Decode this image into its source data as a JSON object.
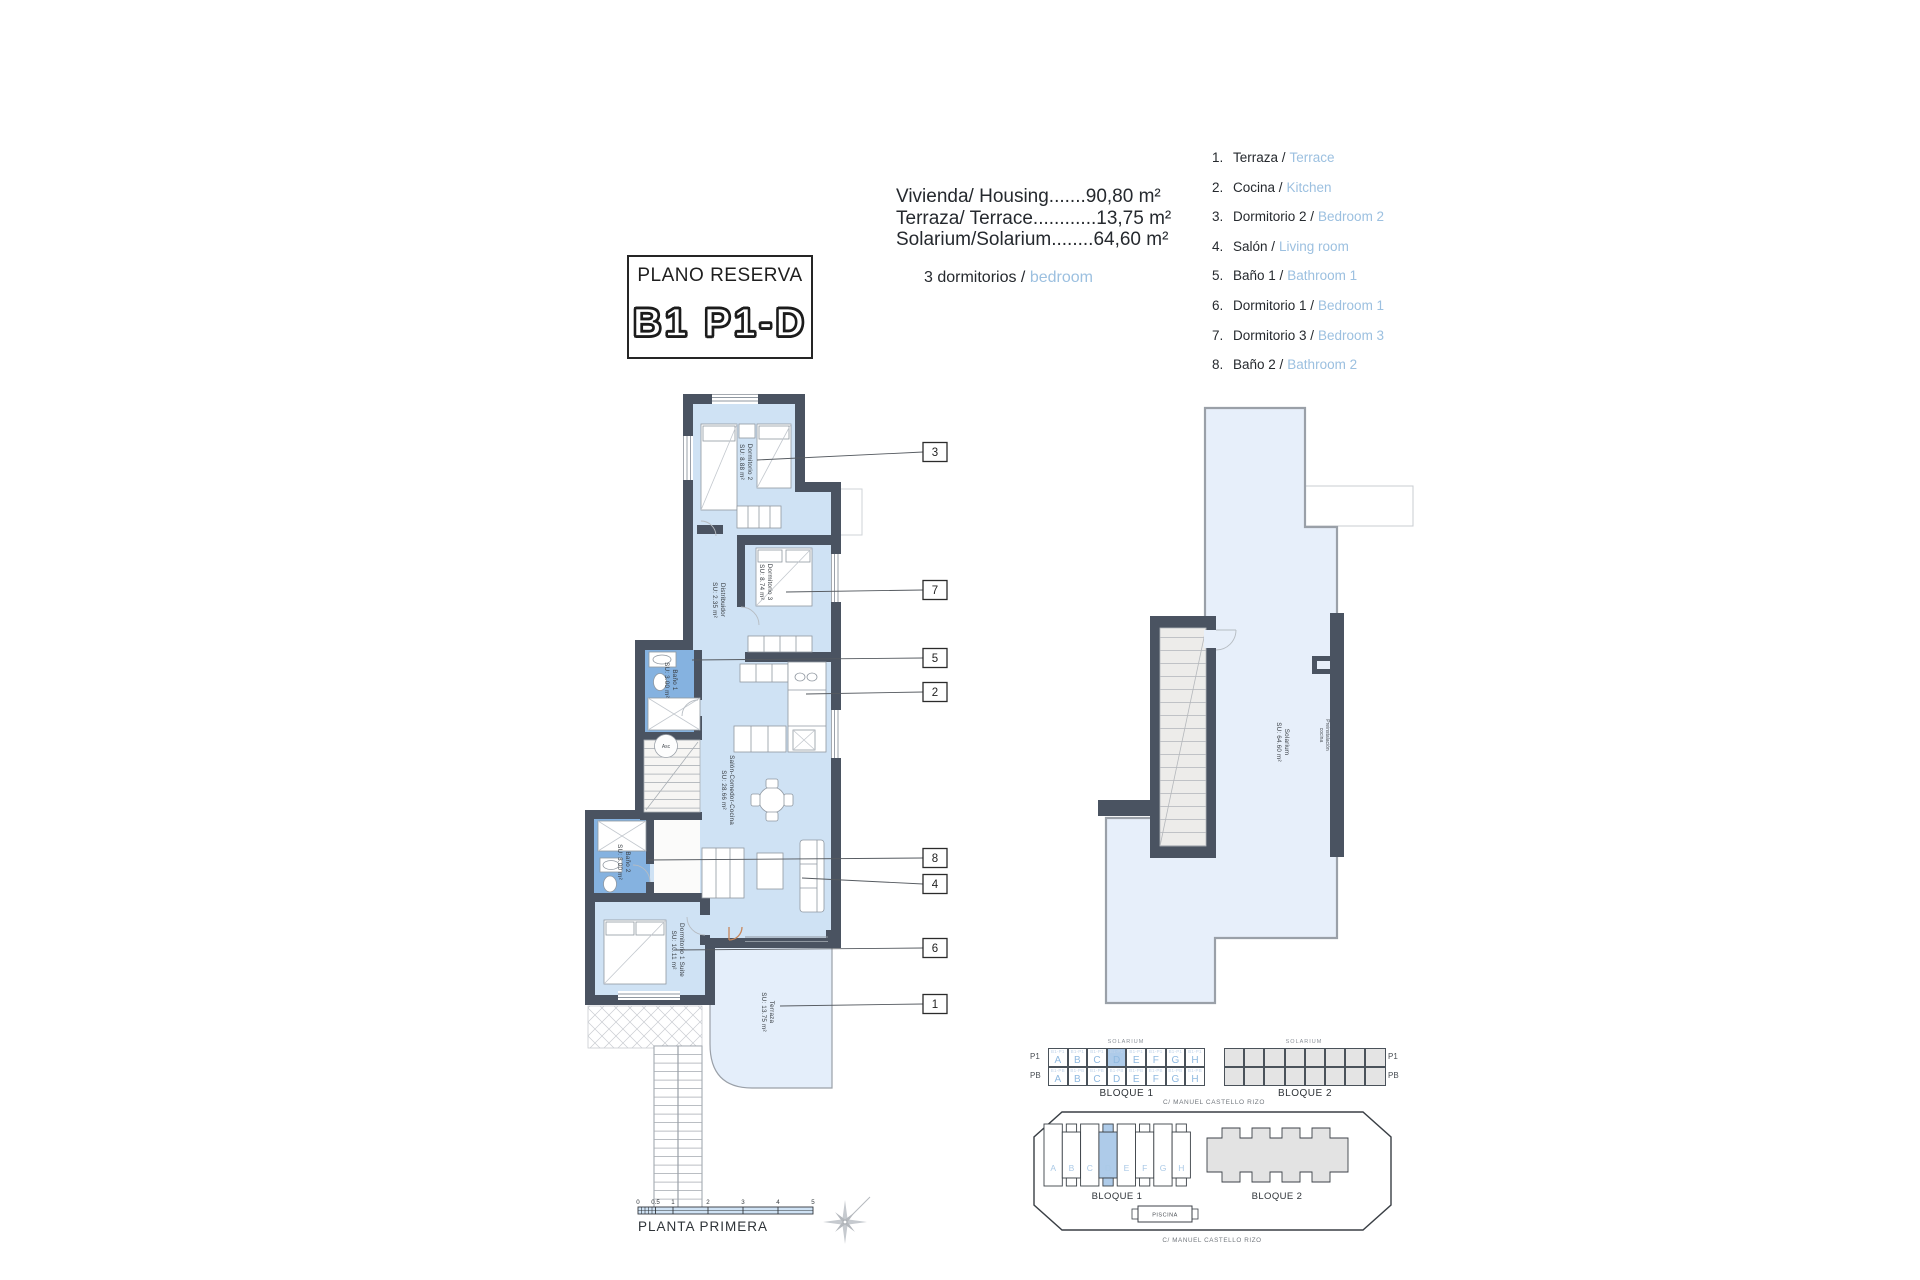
{
  "title_box": {
    "title": "PLANO RESERVA",
    "unit": "B1 P1-D"
  },
  "areas": {
    "line1": "Vivienda/ Housing.......90,80 m²",
    "line2": "Terraza/ Terrace............13,75 m²",
    "line3": "Solarium/Solarium........64,60 m²",
    "bedrooms_es": "3 dormitorios /",
    "bedrooms_en": "bedroom"
  },
  "legend": {
    "items": [
      {
        "num": "1.",
        "es": "Terraza /",
        "en": "Terrace"
      },
      {
        "num": "2.",
        "es": "Cocina /",
        "en": "Kitchen"
      },
      {
        "num": "3.",
        "es": "Dormitorio 2 /",
        "en": "Bedroom 2"
      },
      {
        "num": "4.",
        "es": "Salón /",
        "en": "Living room"
      },
      {
        "num": "5.",
        "es": "Baño 1 /",
        "en": "Bathroom 1"
      },
      {
        "num": "6.",
        "es": "Dormitorio 1 /",
        "en": "Bedroom 1"
      },
      {
        "num": "7.",
        "es": "Dormitorio 3 /",
        "en": "Bedroom 3"
      },
      {
        "num": "8.",
        "es": "Baño 2 /",
        "en": "Bathroom 2"
      }
    ]
  },
  "floor_plan": {
    "callouts": [
      "3",
      "7",
      "5",
      "2",
      "8",
      "4",
      "6",
      "1"
    ],
    "rooms": [
      {
        "name": "Dormitorio 2",
        "area": "SU: 8.88 m²"
      },
      {
        "name": "Dormitorio 3",
        "area": "SU: 8.74 m²"
      },
      {
        "name": "Distribuidor",
        "area": "SU: 2.35 m²"
      },
      {
        "name": "Baño 1",
        "area": "SU: 3.00 m²"
      },
      {
        "name": "Salón-Comedor-Cocina",
        "area": "SU: 28.66 m²"
      },
      {
        "name": "Baño 2",
        "area": "SU: 3.00 m²"
      },
      {
        "name": "Dormitorio 1 Suite",
        "area": "SU: 10.11 m²"
      },
      {
        "name": "Terraza",
        "area": "SU: 13.75 m²"
      }
    ],
    "lift_label": "Asc"
  },
  "solarium_plan": {
    "name": "Solarium",
    "area": "SU: 64.60 m²",
    "note_line1": "Preinstalación",
    "note_line2": "cocina"
  },
  "schedule": {
    "solarium_label": "SOLARIUM",
    "row_labels": [
      "P1",
      "PB"
    ],
    "bloque1": {
      "label": "BLOQUE 1",
      "letters": [
        "A",
        "B",
        "C",
        "D",
        "E",
        "F",
        "G",
        "H"
      ],
      "code_p1": "B1-P1",
      "code_pb": "B1-PB"
    },
    "bloque2": {
      "label": "BLOQUE 2"
    },
    "street": "C/ MANUEL CASTELLO RIZO"
  },
  "site_plan": {
    "letters": [
      "A",
      "B",
      "C",
      "D",
      "E",
      "F",
      "G",
      "H"
    ],
    "bloque1_label": "BLOQUE 1",
    "bloque2_label": "BLOQUE 2",
    "piscina": "PISCINA",
    "street": "C/ MANUEL CASTELLO RIZO"
  },
  "scale_bar": {
    "ticks": [
      "0",
      "0.5",
      "1",
      "2",
      "3",
      "4",
      "5"
    ],
    "label": "PLANTA PRIMERA"
  },
  "colors": {
    "wall": "#4a5361",
    "room": "#cfe2f4",
    "bath": "#85b2e0",
    "terrace": "#e4eefa",
    "accent_blue": "#9cc0e0",
    "highlight_cell": "#aecbe9"
  }
}
